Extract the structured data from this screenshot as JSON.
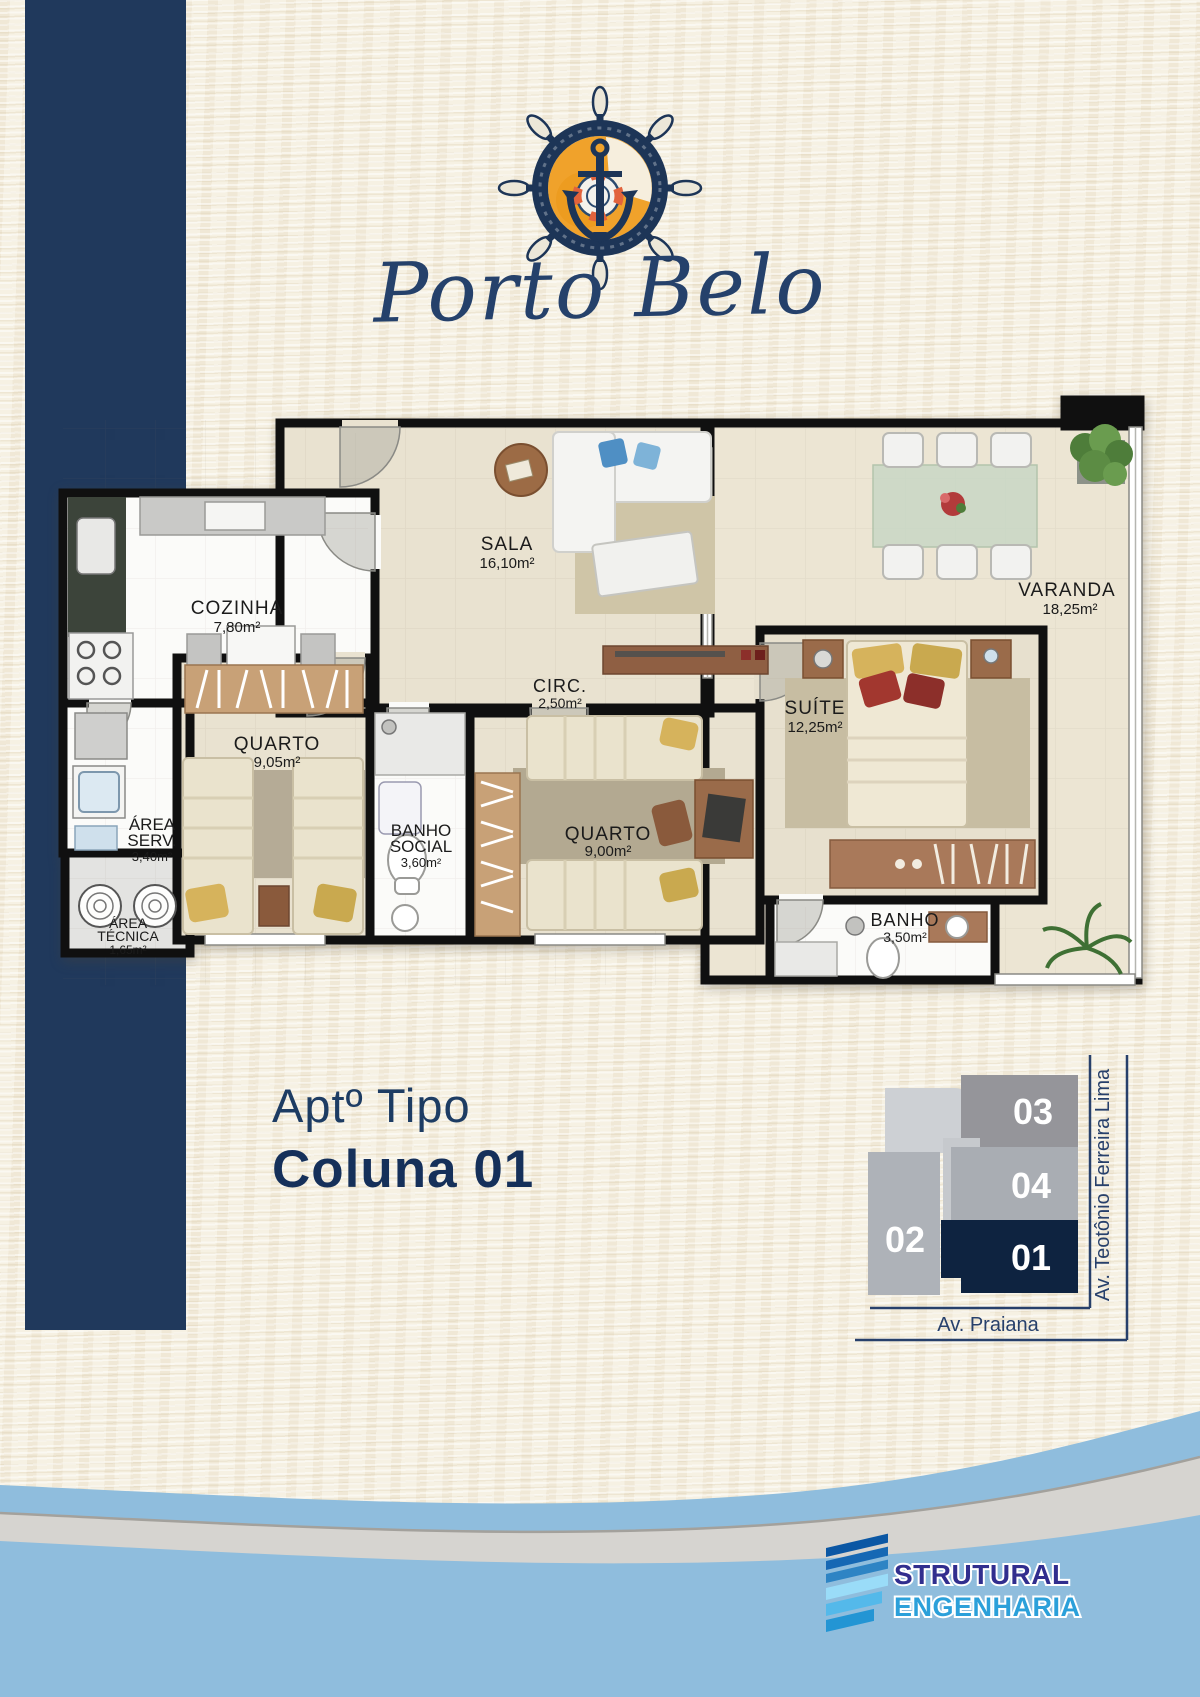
{
  "brand": {
    "logo_script": "Porto Belo"
  },
  "floor_plan": {
    "rooms": {
      "cozinha": {
        "name": "COZINHA",
        "area": "7,80m²"
      },
      "sala": {
        "name": "SALA",
        "area": "16,10m²"
      },
      "varanda": {
        "name": "VARANDA",
        "area": "18,25m²"
      },
      "circ": {
        "name": "CIRC.",
        "area": "2,50m²"
      },
      "suite": {
        "name": "SUÍTE",
        "area": "12,25m²"
      },
      "quarto1": {
        "name": "QUARTO",
        "area": "9,05m²"
      },
      "banho_social": {
        "name": "BANHO",
        "name2": "SOCIAL",
        "area": "3,60m²"
      },
      "area_serv": {
        "name": "ÁREA",
        "name2": "SERV.",
        "area": "3,40m²"
      },
      "area_tecnica": {
        "name": "ÁREA",
        "name2": "TÉCNICA",
        "area": "1,65m²"
      },
      "quarto2": {
        "name": "QUARTO",
        "area": "9,00m²"
      },
      "banho": {
        "name": "BANHO",
        "area": "3,50m²"
      }
    }
  },
  "apartment": {
    "type_label": "Aptº Tipo",
    "column_label": "Coluna 01"
  },
  "location_key": {
    "units": {
      "u01": "01",
      "u02": "02",
      "u03": "03",
      "u04": "04"
    },
    "street_right": "Av. Teotônio Ferreira Lima",
    "street_bottom": "Av. Praiana"
  },
  "builder": {
    "name_line1": "STRUTURAL",
    "name_line2": "ENGENHARIA"
  },
  "colors": {
    "navy_bar": "#20395c",
    "unit_highlight_navy": "#0e2340",
    "logo_orange": "#f0a22b",
    "brand_dark_blue": "#312e8e",
    "brand_light_blue": "#2ba0da",
    "footer_blue": "#8fbddd",
    "footer_gray": "#d6d4d0"
  }
}
